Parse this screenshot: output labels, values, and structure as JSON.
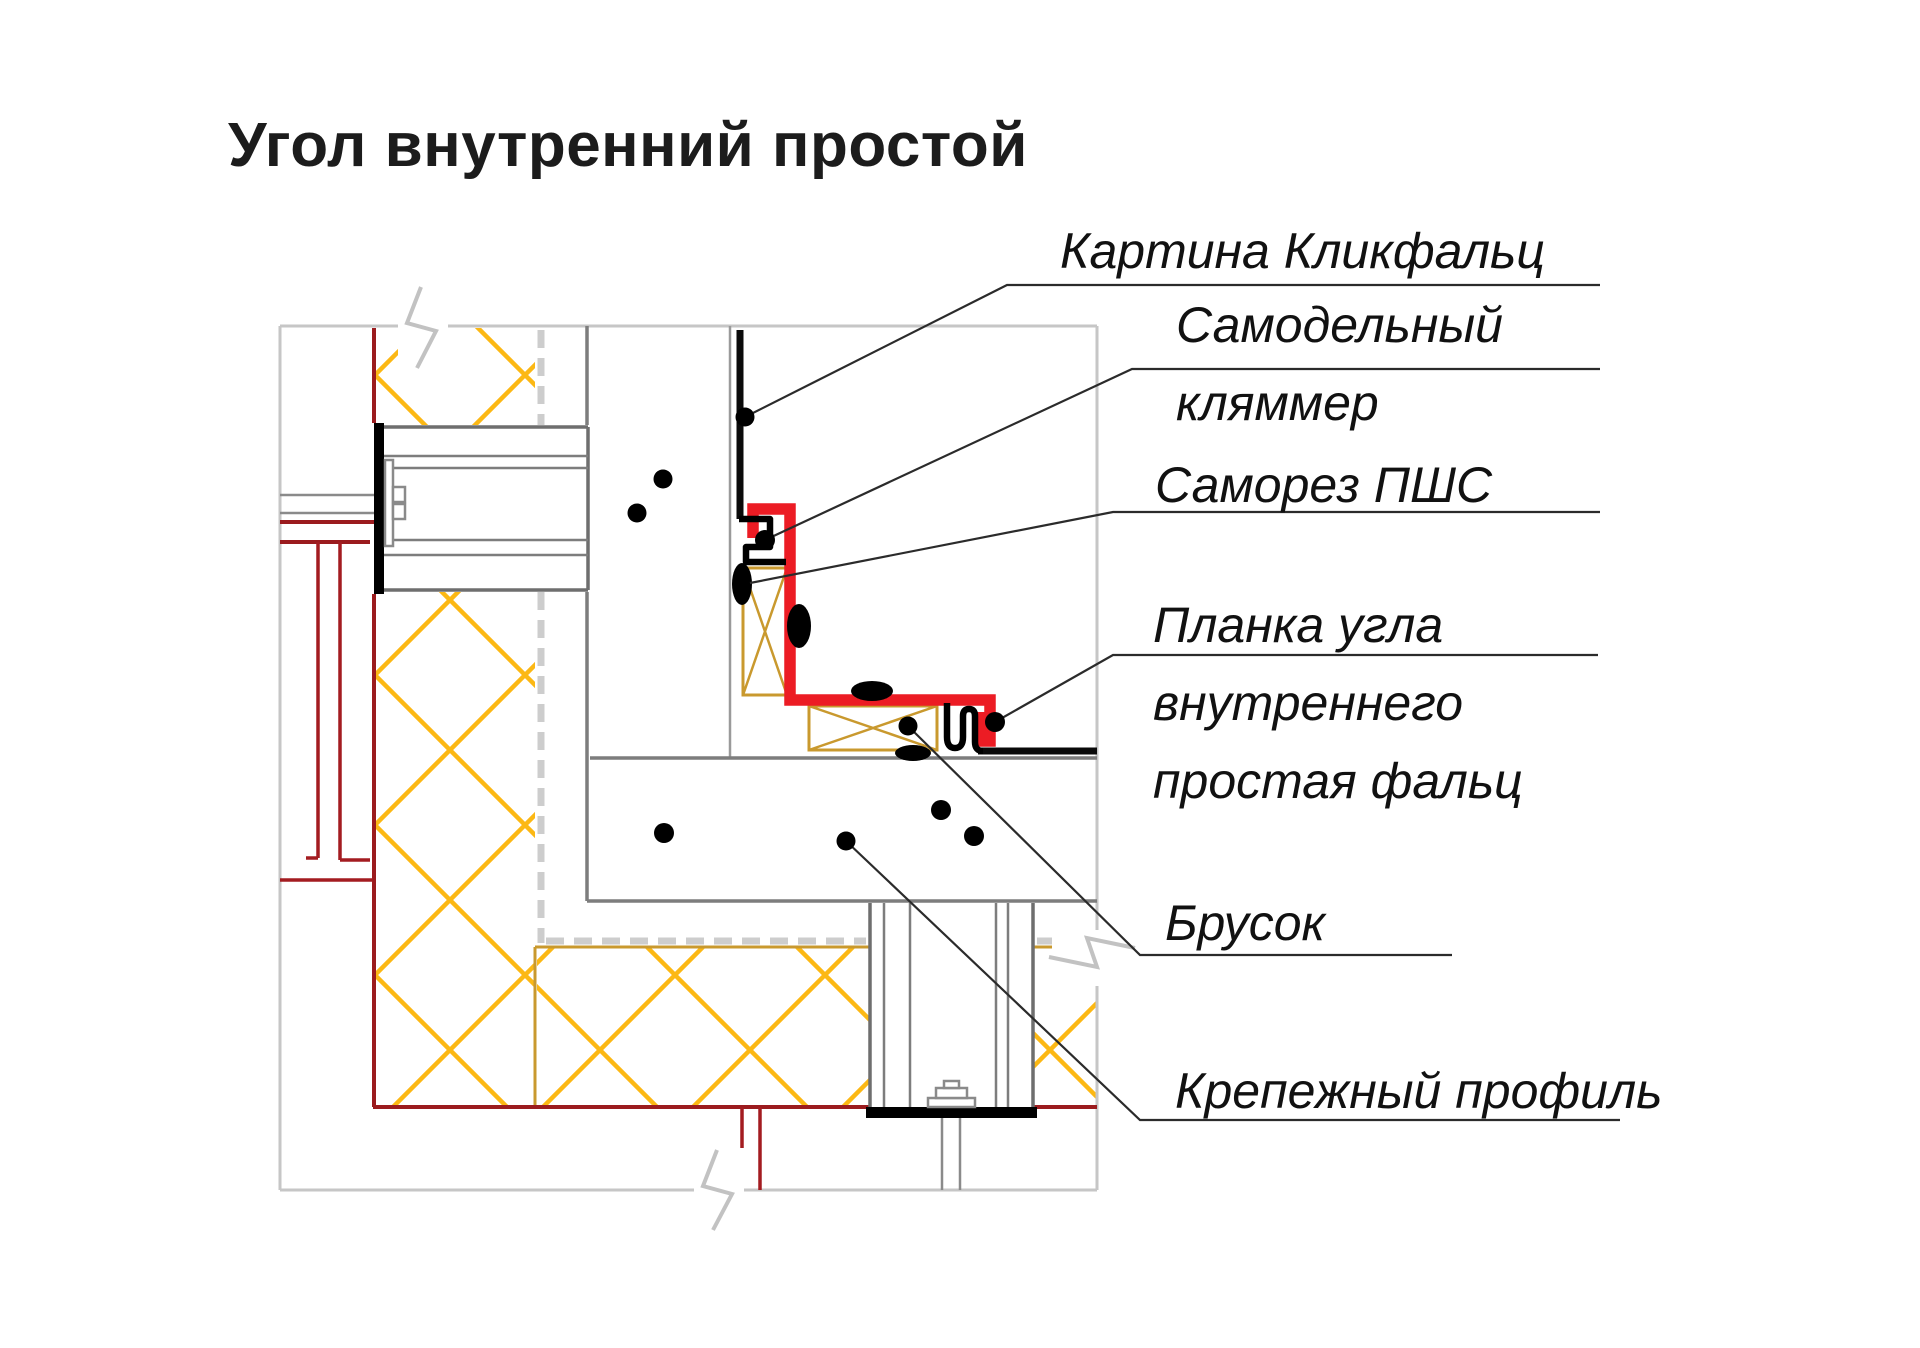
{
  "title": "Угол внутренний простой",
  "labels": {
    "kartina": {
      "lines": [
        "Картина Кликфальц"
      ]
    },
    "klyammer": {
      "lines": [
        "Самодельный",
        "кляммер"
      ]
    },
    "samorez": {
      "lines": [
        "Саморез ПШС"
      ]
    },
    "planka": {
      "lines": [
        "Планка угла",
        "внутреннего",
        "простая фальц"
      ]
    },
    "brusok": {
      "lines": [
        "Брусок"
      ]
    },
    "profil": {
      "lines": [
        "Крепежный профиль"
      ]
    }
  },
  "colors": {
    "panel_red": "#EC1C24",
    "wall_dark_red": "#9B1B1E",
    "insulation_yellow": "#FCB814",
    "timber_tan": "#C9992E",
    "line_gray": "#7D7D7D",
    "boundary_gray": "#C6C6C6",
    "ink_black": "#000000"
  }
}
